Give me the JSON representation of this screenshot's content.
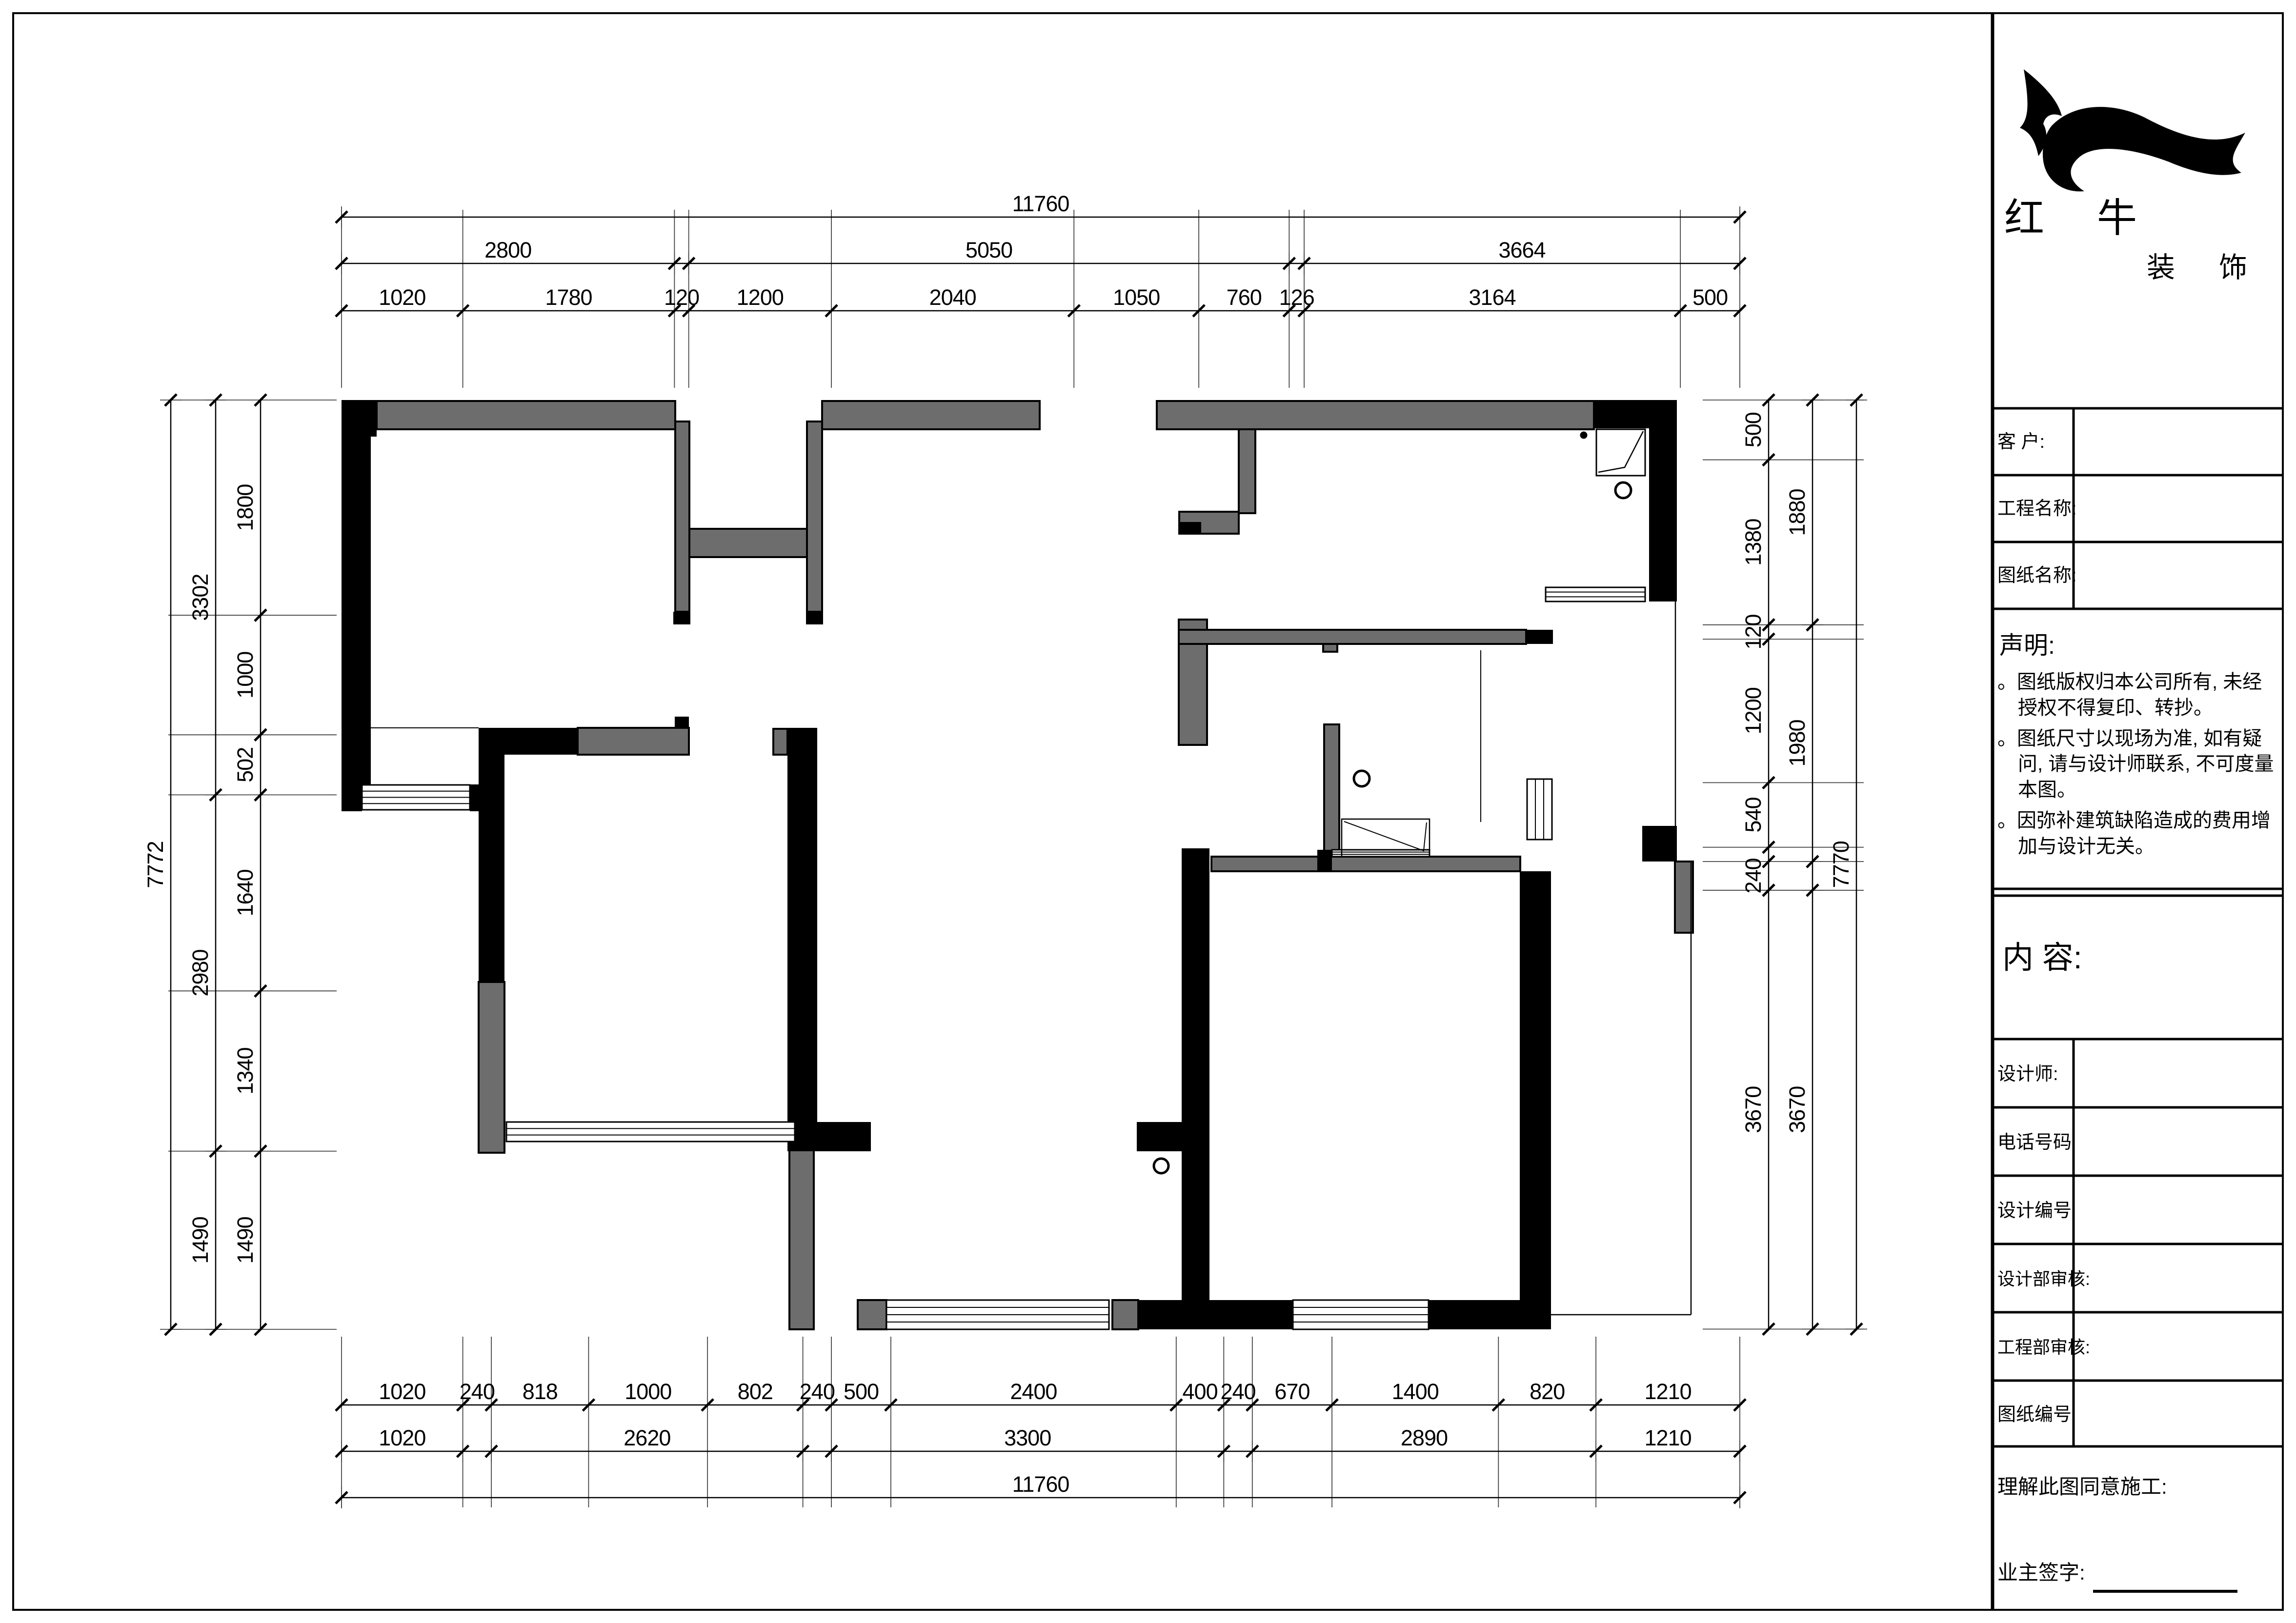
{
  "sheet": {
    "type": "floor-plan construction drawing",
    "background": "#ffffff",
    "wall_black": "#000000",
    "wall_gray": "#6d6d6d"
  },
  "title_block": {
    "company_name": "红牛",
    "company_sub": "装饰",
    "logo_icon": "bull-swoosh-icon",
    "rows": [
      {
        "label": "客  户:"
      },
      {
        "label": "工程名称:"
      },
      {
        "label": "图纸名称:"
      }
    ],
    "statement_title": "声明:",
    "bullet": "。",
    "statement_items": [
      "图纸版权归本公司所有, 未经授权不得复印、转抄。",
      "图纸尺寸以现场为准, 如有疑问, 请与设计师联系, 不可度量本图。",
      "因弥补建筑缺陷造成的费用增加与设计无关。"
    ],
    "content_label": "内  容:",
    "info_rows": [
      "设计师:",
      "电话号码",
      "设计编号",
      "设计部审核:",
      "工程部审核:",
      "图纸编号"
    ],
    "footer_line1": "理解此图同意施工:",
    "footer_line2": "业主签字:"
  },
  "dimensions": {
    "top": {
      "detail": {
        "mm": [
          1020,
          1780,
          120,
          1200,
          2040,
          1050,
          760,
          126,
          3164,
          500
        ],
        "labels": [
          "1020",
          "1780",
          "120",
          "1200",
          "2040",
          "1050",
          "760",
          "126",
          "3164",
          "500"
        ]
      },
      "mid": {
        "mm": [
          2800,
          120,
          5050,
          126,
          3664
        ],
        "labels": [
          "2800",
          "",
          "5050",
          "",
          "3664"
        ]
      },
      "total": {
        "mm": [
          11760
        ],
        "labels": [
          "11760"
        ]
      }
    },
    "bottom": {
      "detail": {
        "mm": [
          1020,
          240,
          818,
          1000,
          802,
          240,
          500,
          2400,
          400,
          240,
          670,
          1400,
          820,
          1210
        ],
        "labels": [
          "1020",
          "240",
          "818",
          "1000",
          "802",
          "240",
          "500",
          "2400",
          "400",
          "240",
          "670",
          "1400",
          "820",
          "1210"
        ]
      },
      "mid": {
        "mm": [
          1020,
          240,
          2620,
          240,
          3300,
          240,
          2890,
          1210
        ],
        "labels": [
          "1020",
          "",
          "2620",
          "",
          "3300",
          "",
          "2890",
          "1210"
        ]
      },
      "total": {
        "mm": [
          11760
        ],
        "labels": [
          "11760"
        ]
      }
    },
    "left": {
      "detail": {
        "mm": [
          1800,
          1000,
          502,
          1640,
          1340,
          1490
        ],
        "labels": [
          "1800",
          "1000",
          "502",
          "1640",
          "1340",
          "1490"
        ]
      },
      "mid": {
        "mm": [
          3302,
          2980,
          1490
        ],
        "labels": [
          "3302",
          "2980",
          "1490"
        ]
      },
      "total": {
        "mm": [
          7772
        ],
        "labels": [
          "7772"
        ]
      }
    },
    "right": {
      "detail": {
        "mm": [
          500,
          1380,
          120,
          1200,
          540,
          120,
          240,
          3670
        ],
        "labels": [
          "500",
          "1380",
          "120",
          "1200",
          "540",
          "",
          "240",
          "3670"
        ]
      },
      "mid": {
        "mm": [
          1880,
          1980,
          240,
          3670
        ],
        "labels": [
          "1880",
          "1980",
          "",
          "3670"
        ]
      },
      "total": {
        "mm": [
          7770
        ],
        "labels": [
          "7770"
        ]
      }
    }
  }
}
